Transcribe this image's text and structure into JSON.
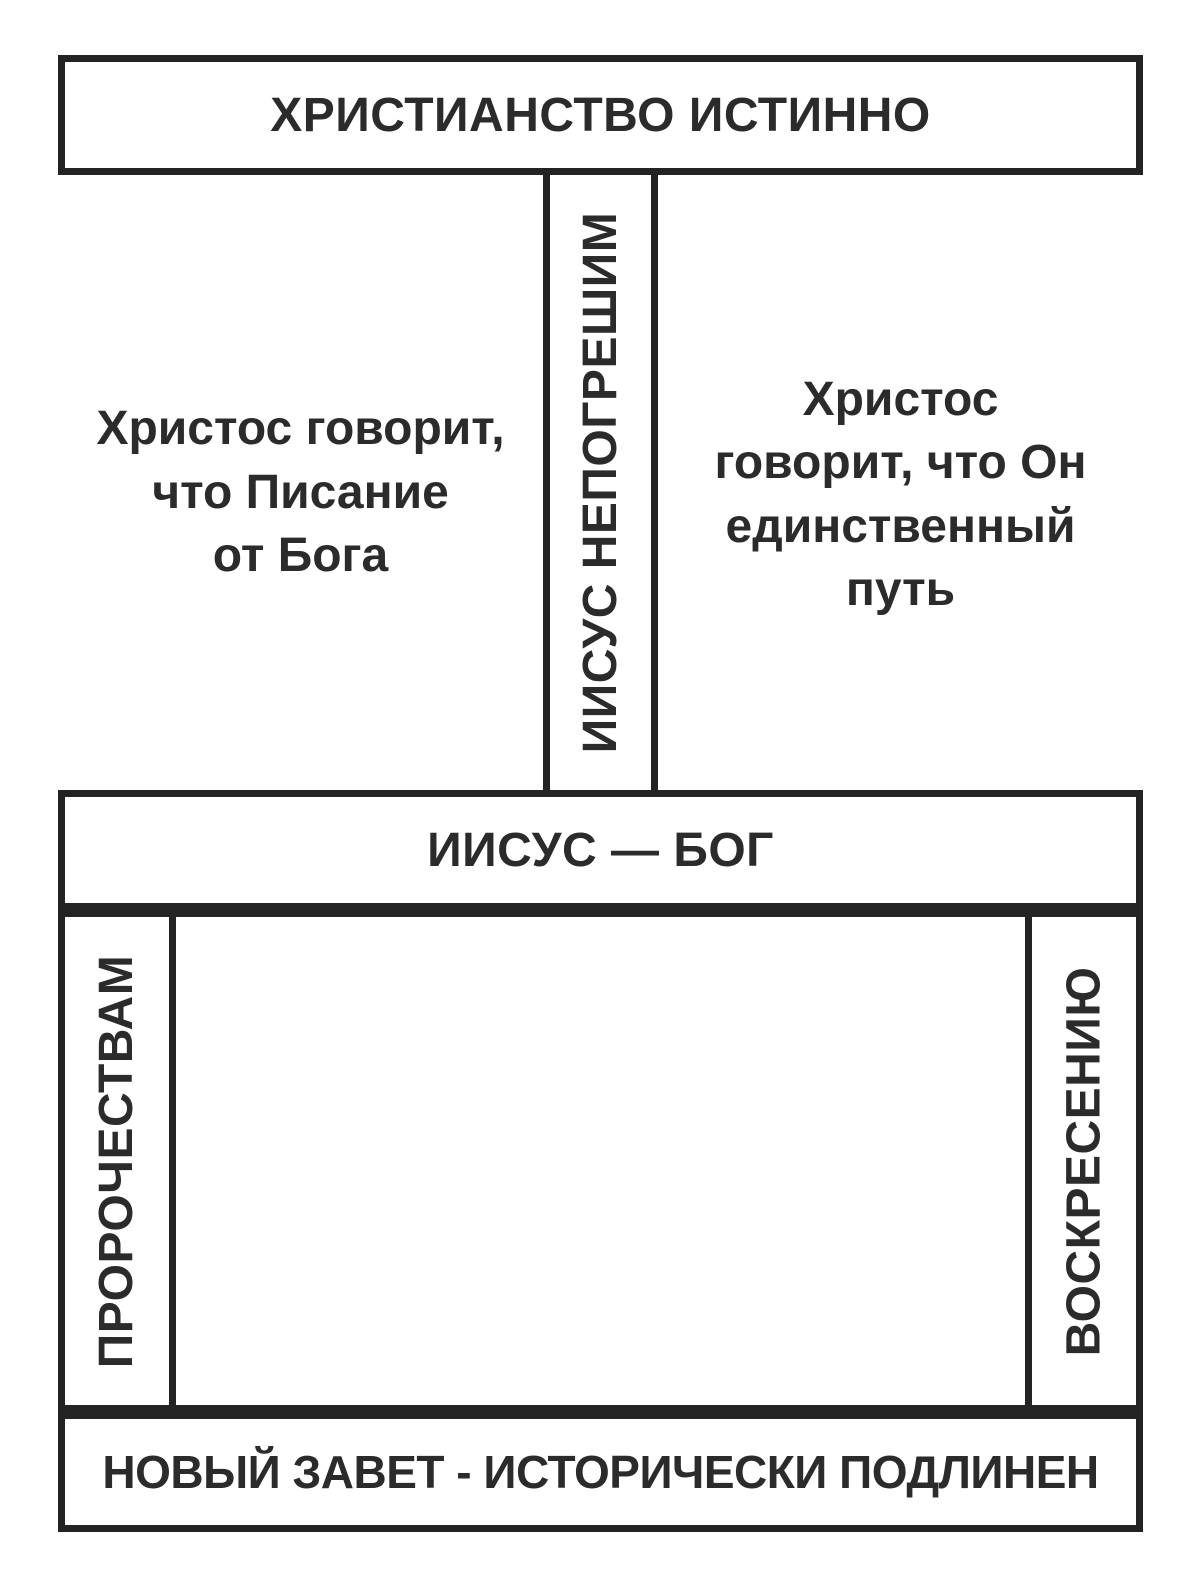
{
  "diagram": {
    "top_box": {
      "label": "ХРИСТИАНСТВО ИСТИННО"
    },
    "pillar": {
      "label": "ИИСУС НЕПОГРЕШИМ"
    },
    "left_note": {
      "lines": [
        "Христос говорит,",
        "что Писание",
        "от Бога"
      ]
    },
    "right_note": {
      "lines": [
        "Христос",
        "говорит, что Он",
        "единственный",
        "путь"
      ]
    },
    "middle_box": {
      "label": "ИИСУС — БОГ"
    },
    "left_pillar": {
      "label": "ПРОРОЧЕСТВАМ"
    },
    "right_pillar": {
      "label": "ВОСКРЕСЕНИЮ"
    },
    "bottom_box": {
      "label": "НОВЫЙ ЗАВЕТ - ИСТОРИЧЕСКИ ПОДЛИНЕН"
    }
  },
  "colors": {
    "stroke": "#232323",
    "text": "#2b2b2b",
    "background": "#ffffff"
  }
}
